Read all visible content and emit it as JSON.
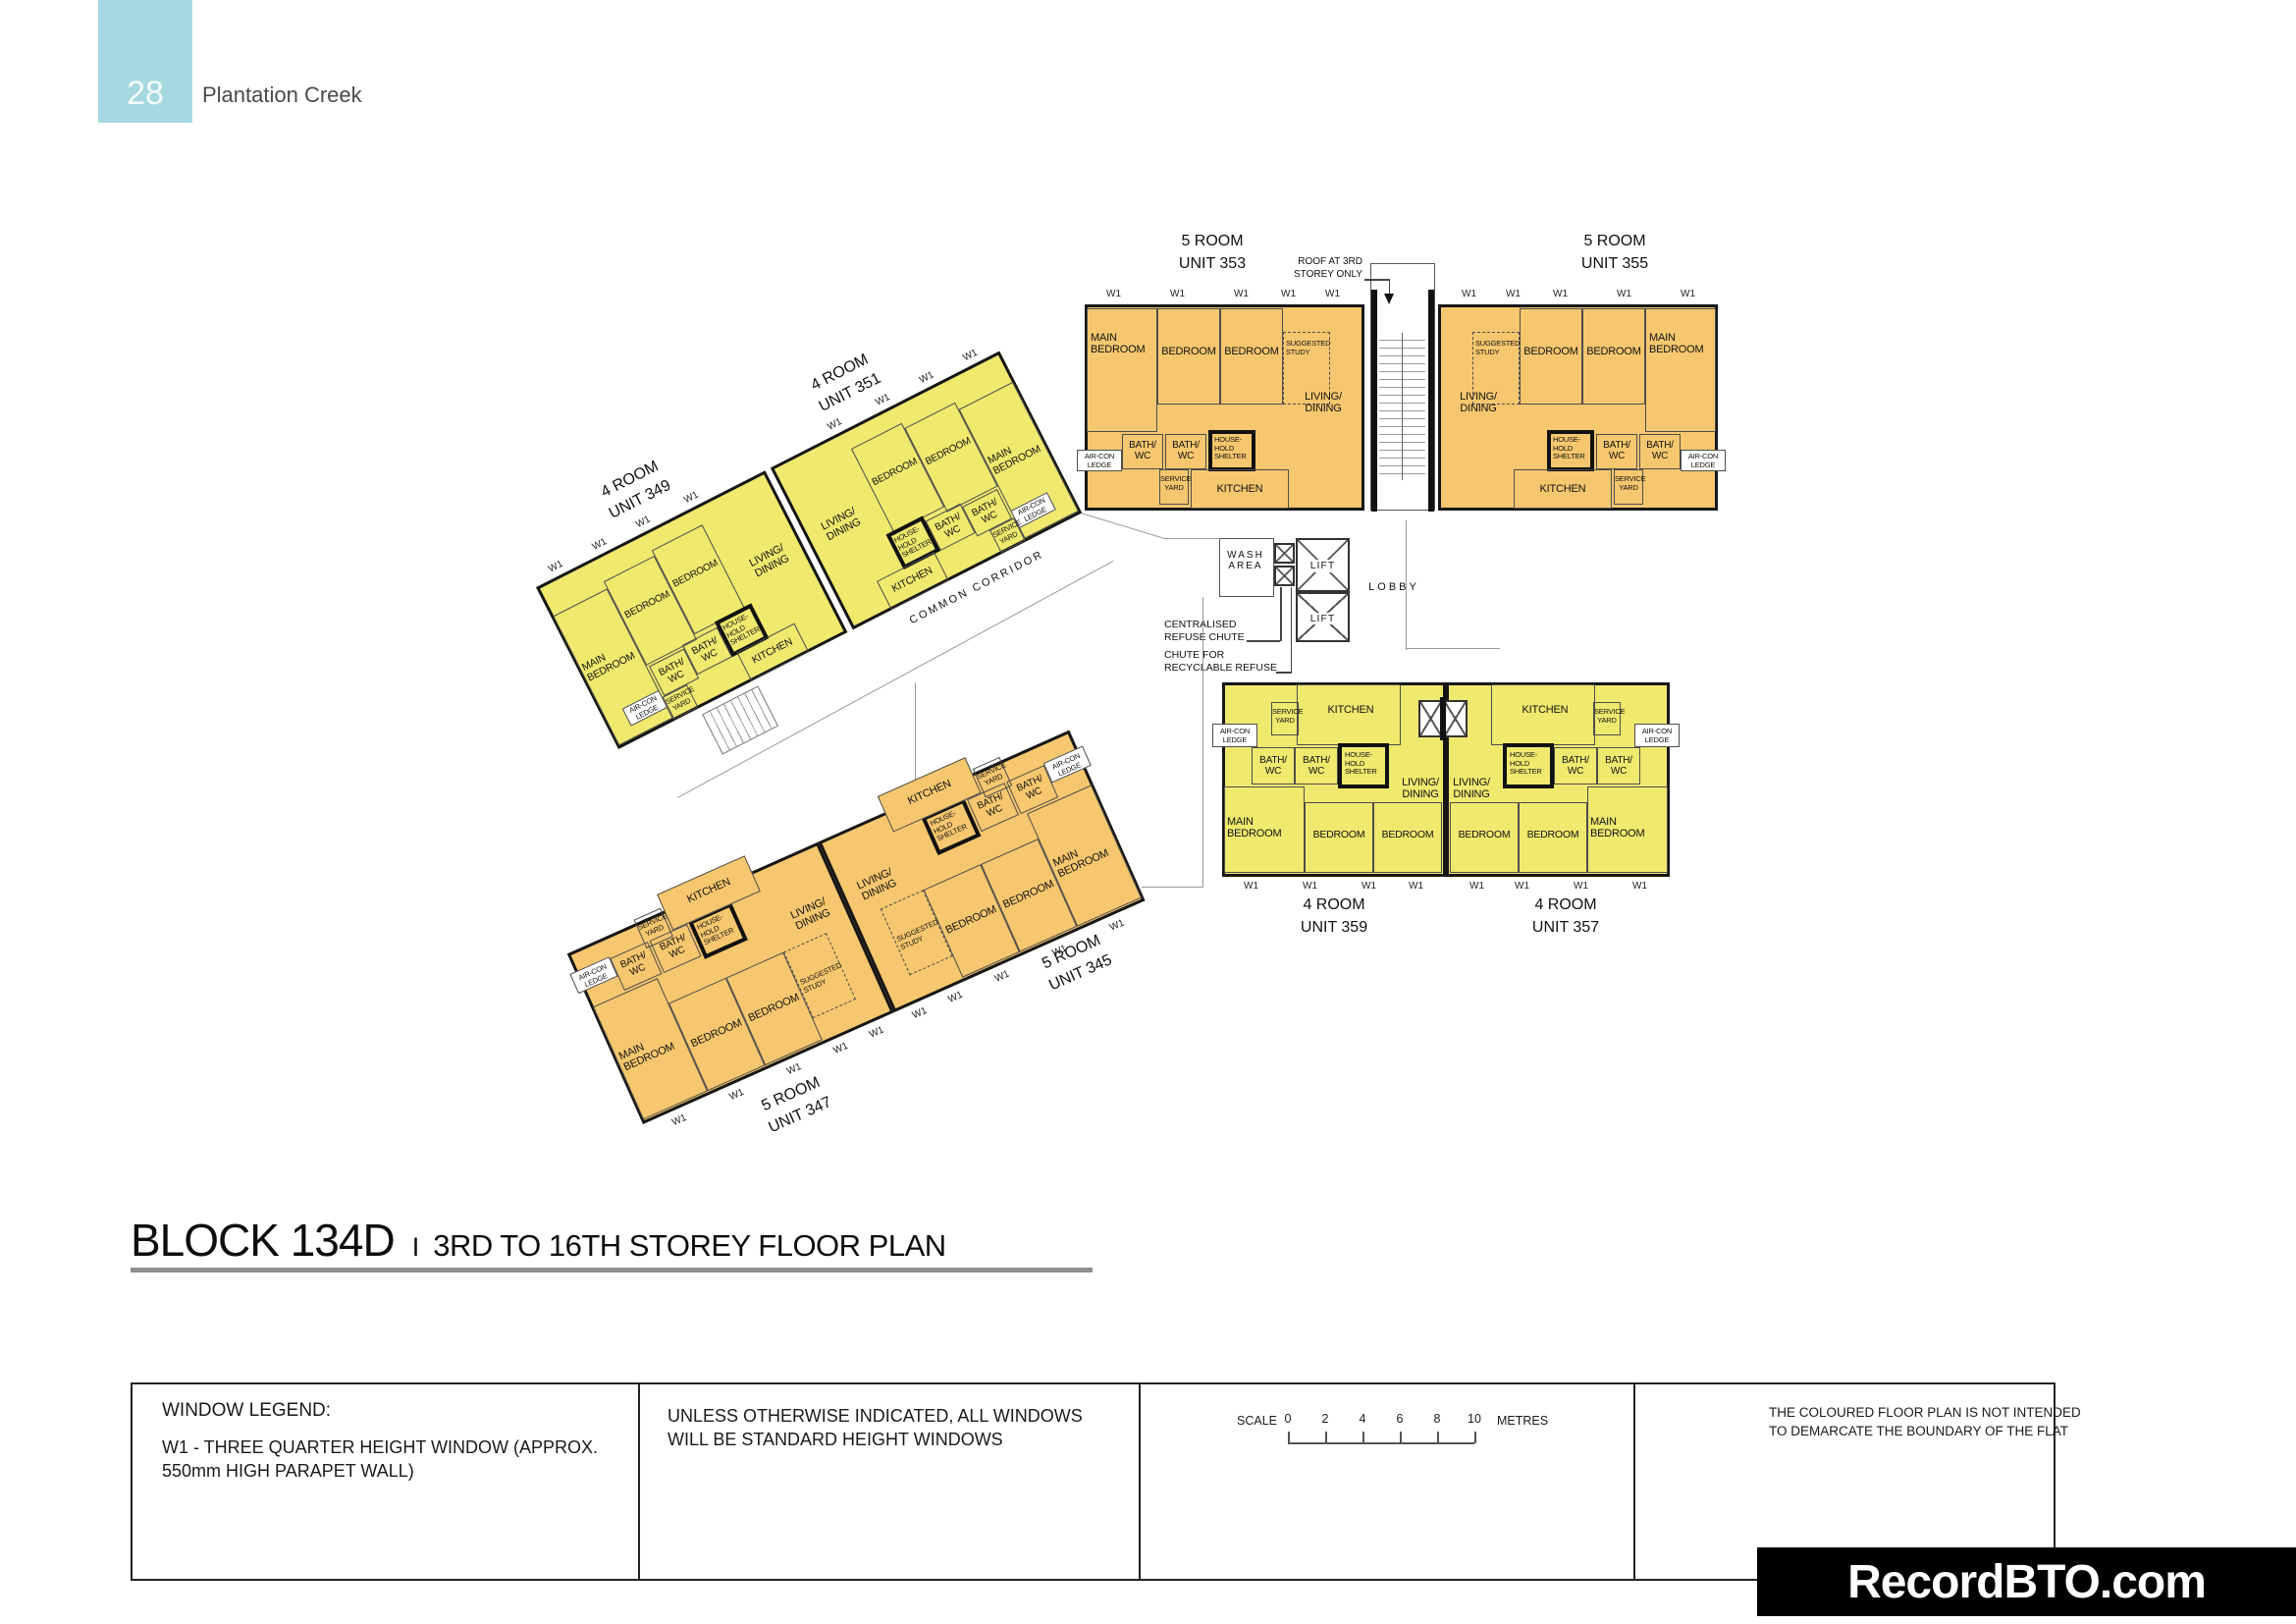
{
  "header": {
    "page_number": "28",
    "project_name": "Plantation Creek"
  },
  "title": {
    "block": "BLOCK 134D",
    "separator": "I",
    "subtitle": "3RD TO 16TH STOREY FLOOR PLAN"
  },
  "colors": {
    "accent_teal": "#A5D8E0",
    "unit_orange": "#F6C76E",
    "unit_yellow": "#EFE96E",
    "wall_black": "#161616"
  },
  "units": {
    "u349": {
      "type": "4 ROOM",
      "number": "UNIT 349"
    },
    "u351": {
      "type": "4 ROOM",
      "number": "UNIT 351"
    },
    "u353": {
      "type": "5 ROOM",
      "number": "UNIT 353"
    },
    "u355": {
      "type": "5 ROOM",
      "number": "UNIT 355"
    },
    "u345": {
      "type": "5 ROOM",
      "number": "UNIT 345"
    },
    "u347": {
      "type": "5 ROOM",
      "number": "UNIT 347"
    },
    "u357": {
      "type": "4 ROOM",
      "number": "UNIT 357"
    },
    "u359": {
      "type": "4 ROOM",
      "number": "UNIT 359"
    }
  },
  "rooms": {
    "main_bedroom": "MAIN\nBEDROOM",
    "bedroom": "BEDROOM",
    "living_dining": "LIVING/\nDINING",
    "kitchen": "KITCHEN",
    "bath_wc": "BATH/\nWC",
    "household_shelter": "HOUSE-\nHOLD\nSHELTER",
    "suggested_study": "SUGGESTED\nSTUDY",
    "service_yard": "SERVICE\nYARD",
    "aircon_ledge": "AIR-CON\nLEDGE",
    "wash_area": "WASH\nAREA",
    "lift": "LIFT",
    "lobby": "LOBBY",
    "common_corridor": "COMMON CORRIDOR"
  },
  "annotations": {
    "roof_note": "ROOF AT 3RD\nSTOREY ONLY",
    "refuse_chute": "CENTRALISED\nREFUSE CHUTE",
    "recyclable_chute": "CHUTE FOR\nRECYCLABLE REFUSE",
    "window_marker": "W1"
  },
  "legend": {
    "window_legend_title": "WINDOW LEGEND:",
    "window_legend_body": "W1  -  THREE QUARTER HEIGHT WINDOW (APPROX.\n550mm HIGH PARAPET WALL)",
    "windows_note": "UNLESS OTHERWISE INDICATED,  ALL WINDOWS\nWILL BE STANDARD HEIGHT WINDOWS",
    "scale_label": "SCALE",
    "scale_ticks": [
      "0",
      "2",
      "4",
      "6",
      "8",
      "10"
    ],
    "scale_unit": "METRES",
    "disclaimer": "THE COLOURED FLOOR PLAN IS NOT INTENDED\nTO DEMARCATE THE BOUNDARY OF THE FLAT"
  },
  "watermark": "RecordBTO.com"
}
